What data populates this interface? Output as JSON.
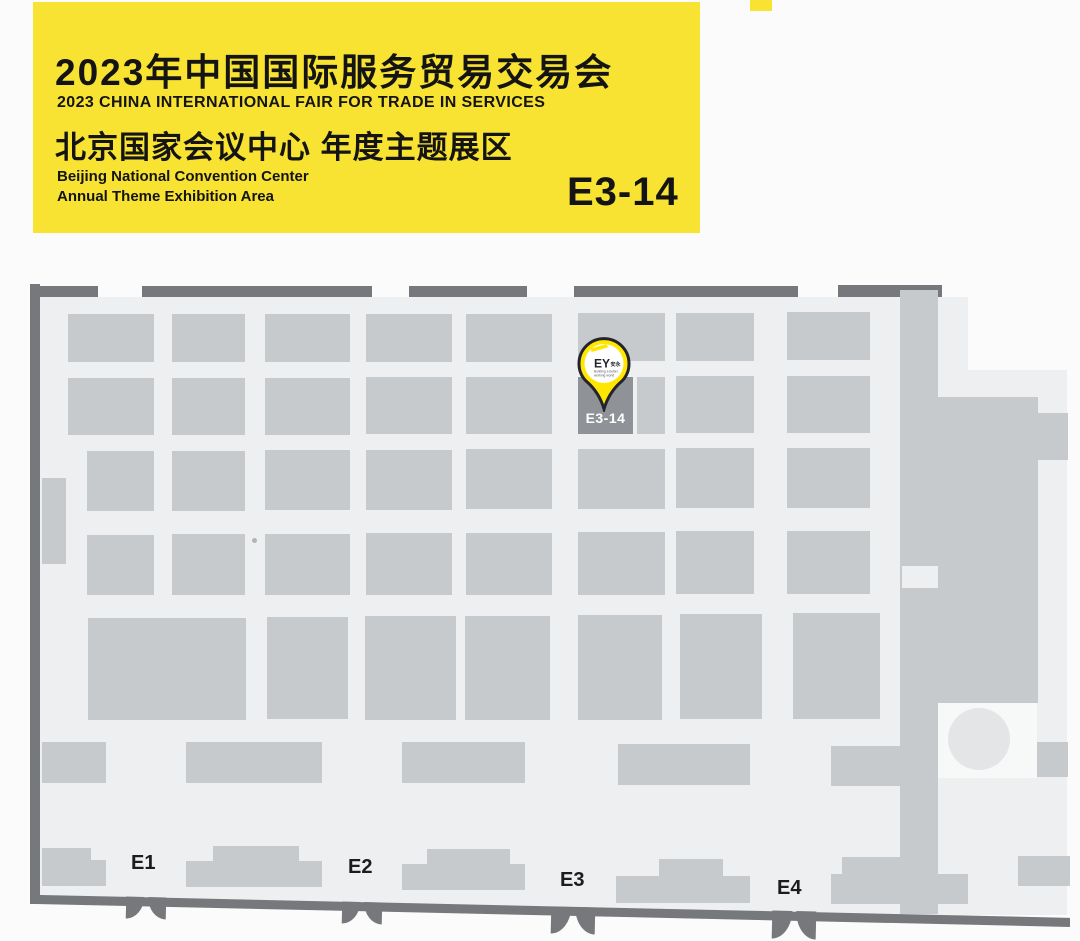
{
  "page": {
    "background": "#fbfbfb"
  },
  "banner": {
    "title_cn": "2023年中国国际服务贸易交易会",
    "title_en": "2023 CHINA INTERNATIONAL FAIR FOR TRADE IN SERVICES",
    "venue_cn": "北京国家会议中心  年度主题展区",
    "venue_en_line1": "Beijing National Convention Center",
    "venue_en_line2": "Annual Theme Exhibition Area",
    "booth_number": "E3-14",
    "colors": {
      "background": "#f8e332",
      "text": "#141414"
    }
  },
  "map": {
    "colors": {
      "floor": "#edeff0",
      "booth": "#c6cacd",
      "wall": "#76787b",
      "highlight_booth": "#8f9296",
      "highlight_text": "#ffffff"
    },
    "highlight_booth": {
      "label": "E3-14"
    },
    "pin": {
      "logo": "EY",
      "logo_cjk": "安永",
      "tagline_line1": "Building a better",
      "tagline_line2": "working world",
      "fill": "#ffe600",
      "outline": "#23232e"
    },
    "entrances": [
      {
        "label": "E1",
        "label_x": 131,
        "label_y": 852,
        "door_x": 126,
        "door_y": 897,
        "door_w": 40,
        "door_h": 22
      },
      {
        "label": "E2",
        "label_x": 348,
        "label_y": 856,
        "door_x": 342,
        "door_y": 902,
        "door_w": 40,
        "door_h": 22
      },
      {
        "label": "E3",
        "label_x": 560,
        "label_y": 869,
        "door_x": 551,
        "door_y": 907,
        "door_w": 44,
        "door_h": 27
      },
      {
        "label": "E4",
        "label_x": 777,
        "label_y": 877,
        "door_x": 772,
        "door_y": 911,
        "door_w": 44,
        "door_h": 28
      }
    ],
    "blocks": [
      {
        "n": "left-wall",
        "s": "w",
        "x": 30,
        "y": 284,
        "w": 10,
        "h": 620
      },
      {
        "n": "top-wall-segment",
        "s": "w",
        "x": 40,
        "y": 286,
        "w": 58,
        "h": 11
      },
      {
        "n": "top-wall-segment",
        "s": "w",
        "x": 142,
        "y": 286,
        "w": 230,
        "h": 11
      },
      {
        "n": "top-wall-segment",
        "s": "w",
        "x": 409,
        "y": 286,
        "w": 118,
        "h": 11
      },
      {
        "n": "top-wall-segment",
        "s": "w",
        "x": 574,
        "y": 286,
        "w": 224,
        "h": 11
      },
      {
        "n": "top-wall-segment",
        "s": "w",
        "x": 838,
        "y": 285,
        "w": 104,
        "h": 12
      },
      {
        "n": "booth-block",
        "s": "b",
        "x": 68,
        "y": 314,
        "w": 86,
        "h": 48
      },
      {
        "n": "booth-block",
        "s": "b",
        "x": 172,
        "y": 314,
        "w": 73,
        "h": 48
      },
      {
        "n": "booth-block",
        "s": "b",
        "x": 265,
        "y": 314,
        "w": 85,
        "h": 48
      },
      {
        "n": "booth-block",
        "s": "b",
        "x": 366,
        "y": 314,
        "w": 86,
        "h": 48
      },
      {
        "n": "booth-block",
        "s": "b",
        "x": 466,
        "y": 314,
        "w": 86,
        "h": 48
      },
      {
        "n": "booth-block",
        "s": "b",
        "x": 578,
        "y": 313,
        "w": 87,
        "h": 48
      },
      {
        "n": "booth-block",
        "s": "b",
        "x": 676,
        "y": 313,
        "w": 78,
        "h": 48
      },
      {
        "n": "booth-block",
        "s": "b",
        "x": 787,
        "y": 312,
        "w": 83,
        "h": 48
      },
      {
        "n": "booth-block",
        "s": "b",
        "x": 68,
        "y": 378,
        "w": 86,
        "h": 57
      },
      {
        "n": "booth-block",
        "s": "b",
        "x": 172,
        "y": 378,
        "w": 73,
        "h": 57
      },
      {
        "n": "booth-block",
        "s": "b",
        "x": 265,
        "y": 378,
        "w": 85,
        "h": 57
      },
      {
        "n": "booth-block",
        "s": "b",
        "x": 366,
        "y": 377,
        "w": 86,
        "h": 57
      },
      {
        "n": "booth-block",
        "s": "b",
        "x": 466,
        "y": 377,
        "w": 86,
        "h": 57
      },
      {
        "n": "booth-block",
        "s": "b",
        "x": 637,
        "y": 377,
        "w": 28,
        "h": 57
      },
      {
        "n": "booth-block",
        "s": "b",
        "x": 676,
        "y": 376,
        "w": 78,
        "h": 57
      },
      {
        "n": "booth-block",
        "s": "b",
        "x": 787,
        "y": 376,
        "w": 83,
        "h": 57
      },
      {
        "n": "booth-block",
        "s": "b",
        "x": 87,
        "y": 451,
        "w": 67,
        "h": 60
      },
      {
        "n": "booth-block",
        "s": "b",
        "x": 172,
        "y": 451,
        "w": 73,
        "h": 60
      },
      {
        "n": "booth-block",
        "s": "b",
        "x": 265,
        "y": 450,
        "w": 85,
        "h": 60
      },
      {
        "n": "booth-block",
        "s": "b",
        "x": 366,
        "y": 450,
        "w": 86,
        "h": 60
      },
      {
        "n": "booth-block",
        "s": "b",
        "x": 466,
        "y": 449,
        "w": 86,
        "h": 60
      },
      {
        "n": "booth-block",
        "s": "b",
        "x": 578,
        "y": 449,
        "w": 87,
        "h": 60
      },
      {
        "n": "booth-block",
        "s": "b",
        "x": 676,
        "y": 448,
        "w": 78,
        "h": 60
      },
      {
        "n": "booth-block",
        "s": "b",
        "x": 787,
        "y": 448,
        "w": 83,
        "h": 60
      },
      {
        "n": "booth-block",
        "s": "b",
        "x": 87,
        "y": 535,
        "w": 67,
        "h": 60
      },
      {
        "n": "booth-block",
        "s": "b",
        "x": 172,
        "y": 534,
        "w": 73,
        "h": 61
      },
      {
        "n": "booth-block",
        "s": "b",
        "x": 265,
        "y": 534,
        "w": 85,
        "h": 61
      },
      {
        "n": "booth-block",
        "s": "b",
        "x": 366,
        "y": 533,
        "w": 86,
        "h": 62
      },
      {
        "n": "booth-block",
        "s": "b",
        "x": 466,
        "y": 533,
        "w": 86,
        "h": 62
      },
      {
        "n": "booth-block",
        "s": "b",
        "x": 578,
        "y": 532,
        "w": 87,
        "h": 63
      },
      {
        "n": "booth-block",
        "s": "b",
        "x": 676,
        "y": 531,
        "w": 78,
        "h": 63
      },
      {
        "n": "booth-block",
        "s": "b",
        "x": 787,
        "y": 531,
        "w": 83,
        "h": 63
      },
      {
        "n": "booth-block",
        "s": "b",
        "x": 88,
        "y": 618,
        "w": 158,
        "h": 102
      },
      {
        "n": "booth-block",
        "s": "b",
        "x": 267,
        "y": 617,
        "w": 81,
        "h": 102
      },
      {
        "n": "booth-block",
        "s": "b",
        "x": 365,
        "y": 616,
        "w": 91,
        "h": 104
      },
      {
        "n": "booth-block",
        "s": "b",
        "x": 465,
        "y": 616,
        "w": 85,
        "h": 104
      },
      {
        "n": "booth-block",
        "s": "b",
        "x": 578,
        "y": 615,
        "w": 84,
        "h": 105
      },
      {
        "n": "booth-block",
        "s": "b",
        "x": 680,
        "y": 614,
        "w": 82,
        "h": 105
      },
      {
        "n": "booth-block",
        "s": "b",
        "x": 793,
        "y": 613,
        "w": 87,
        "h": 106
      },
      {
        "n": "booth-block",
        "s": "b",
        "x": 42,
        "y": 742,
        "w": 64,
        "h": 41
      },
      {
        "n": "booth-block",
        "s": "b",
        "x": 186,
        "y": 742,
        "w": 136,
        "h": 41
      },
      {
        "n": "booth-block",
        "s": "b",
        "x": 402,
        "y": 742,
        "w": 123,
        "h": 41
      },
      {
        "n": "booth-block",
        "s": "b",
        "x": 618,
        "y": 744,
        "w": 132,
        "h": 41
      },
      {
        "n": "booth-block",
        "s": "b",
        "x": 831,
        "y": 746,
        "w": 107,
        "h": 40
      },
      {
        "n": "booth-block",
        "s": "b",
        "x": 42,
        "y": 478,
        "w": 24,
        "h": 86
      },
      {
        "n": "wall-band",
        "s": "b",
        "x": 900,
        "y": 290,
        "w": 38,
        "h": 624
      },
      {
        "n": "floor-gap",
        "s": "f",
        "x": 902,
        "y": 566,
        "w": 36,
        "h": 22
      },
      {
        "n": "structure-block",
        "s": "b",
        "x": 938,
        "y": 397,
        "w": 100,
        "h": 306
      },
      {
        "n": "structure-block",
        "s": "b",
        "x": 1038,
        "y": 413,
        "w": 30,
        "h": 47
      },
      {
        "n": "structure-block",
        "s": "b",
        "x": 1035,
        "y": 742,
        "w": 33,
        "h": 35
      },
      {
        "n": "structure-block",
        "s": "b",
        "x": 1018,
        "y": 856,
        "w": 52,
        "h": 30
      },
      {
        "n": "entrance-bump",
        "s": "b",
        "x": 42,
        "y": 848,
        "w": 49,
        "h": 14
      },
      {
        "n": "entrance-bump",
        "s": "b",
        "x": 42,
        "y": 860,
        "w": 64,
        "h": 26
      },
      {
        "n": "entrance-bump",
        "s": "b",
        "x": 213,
        "y": 846,
        "w": 86,
        "h": 16
      },
      {
        "n": "entrance-bump",
        "s": "b",
        "x": 186,
        "y": 861,
        "w": 136,
        "h": 26
      },
      {
        "n": "entrance-bump",
        "s": "b",
        "x": 427,
        "y": 849,
        "w": 83,
        "h": 16
      },
      {
        "n": "entrance-bump",
        "s": "b",
        "x": 402,
        "y": 864,
        "w": 123,
        "h": 26
      },
      {
        "n": "entrance-bump",
        "s": "b",
        "x": 659,
        "y": 859,
        "w": 64,
        "h": 18
      },
      {
        "n": "entrance-bump",
        "s": "b",
        "x": 616,
        "y": 876,
        "w": 134,
        "h": 27
      },
      {
        "n": "entrance-bump",
        "s": "b",
        "x": 842,
        "y": 857,
        "w": 60,
        "h": 18
      },
      {
        "n": "entrance-bump",
        "s": "b",
        "x": 831,
        "y": 874,
        "w": 137,
        "h": 30
      }
    ]
  }
}
